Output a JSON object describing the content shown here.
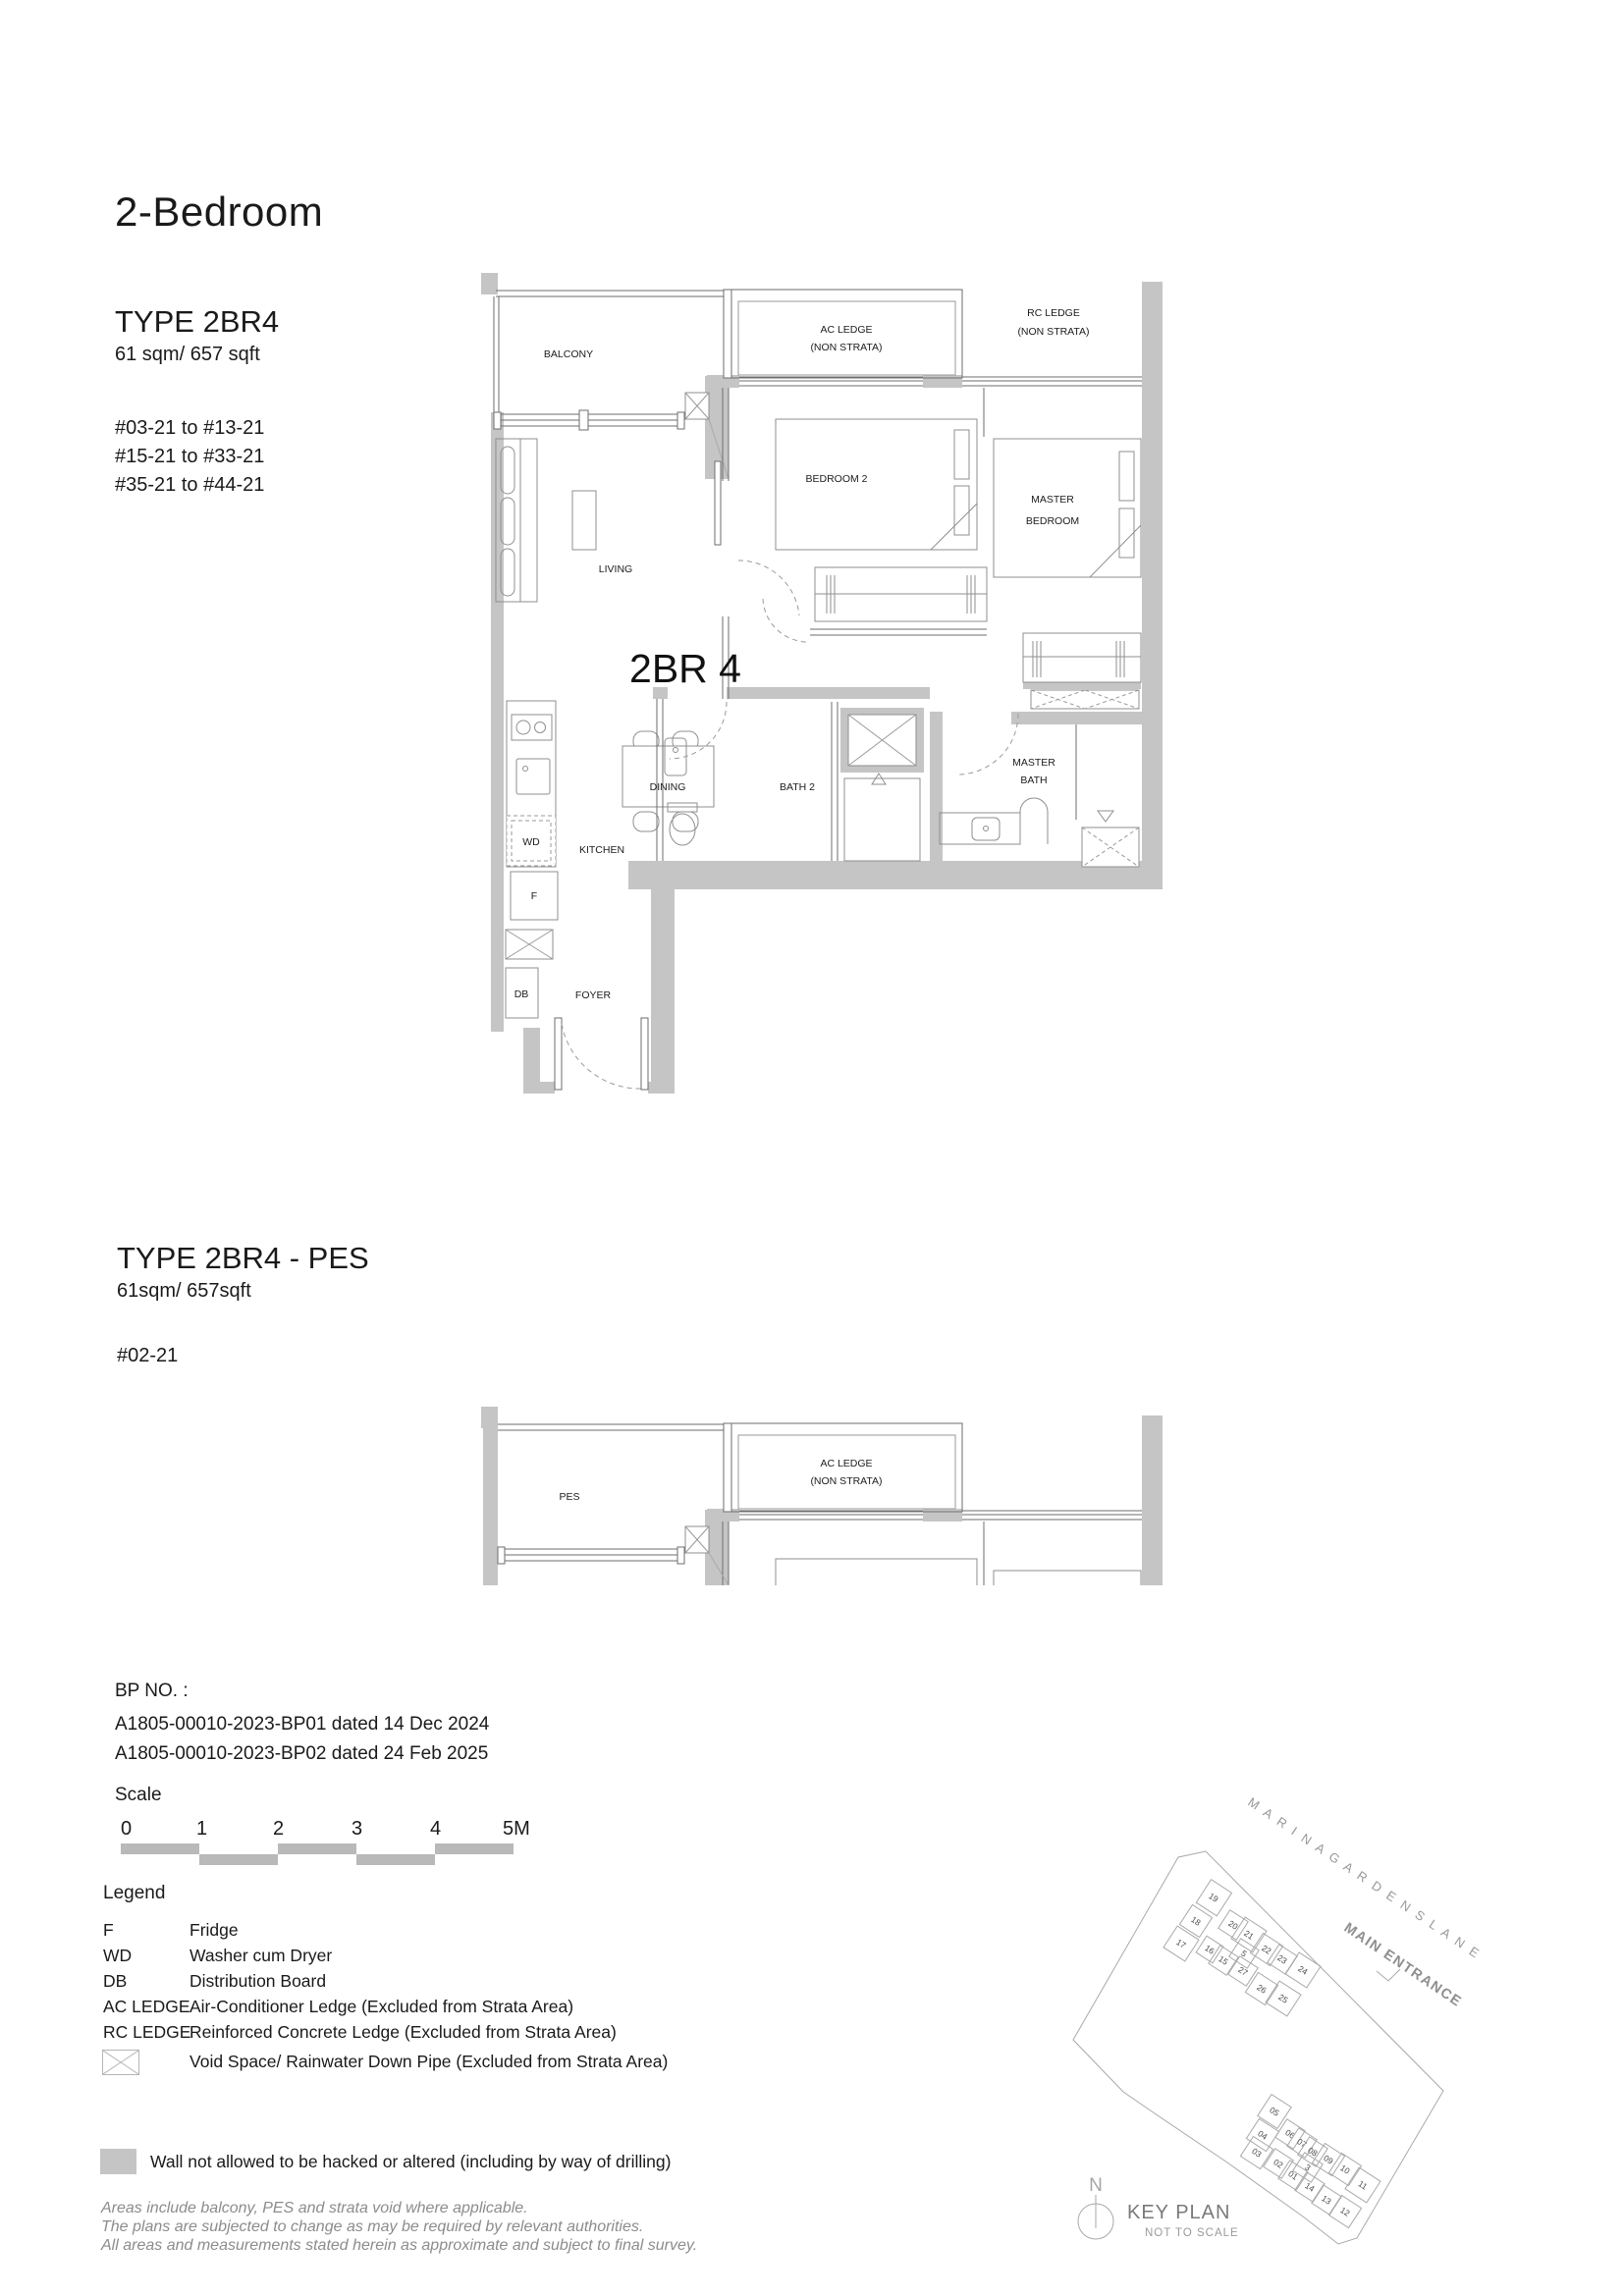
{
  "page": {
    "title": "2-Bedroom"
  },
  "unit_a": {
    "type_title": "TYPE 2BR4",
    "area": "61 sqm/ 657 sqft",
    "levels": [
      "#03-21 to #13-21",
      "#15-21 to #33-21",
      "#35-21 to #44-21"
    ],
    "plan_label": "2BR 4"
  },
  "unit_b": {
    "type_title": "TYPE 2BR4 - PES",
    "area": "61sqm/ 657sqft",
    "levels": [
      "#02-21"
    ]
  },
  "rooms": {
    "balcony": "BALCONY",
    "pes": "PES",
    "ac_ledge": "AC LEDGE",
    "ac_ledge_sub": "(NON STRATA)",
    "rc_ledge": "RC LEDGE",
    "rc_ledge_sub": "(NON STRATA)",
    "living": "LIVING",
    "bedroom2": "BEDROOM 2",
    "master_bedroom_1": "MASTER",
    "master_bedroom_2": "BEDROOM",
    "dining": "DINING",
    "kitchen": "KITCHEN",
    "bath2": "BATH 2",
    "master_bath_1": "MASTER",
    "master_bath_2": "BATH",
    "wd": "WD",
    "f": "F",
    "db": "DB",
    "foyer": "FOYER"
  },
  "bp": {
    "heading": "BP NO. :",
    "line1": "A1805-00010-2023-BP01 dated 14 Dec 2024",
    "line2": "A1805-00010-2023-BP02 dated 24 Feb 2025"
  },
  "scale": {
    "heading": "Scale",
    "ticks": [
      "0",
      "1",
      "2",
      "3",
      "4",
      "5M"
    ]
  },
  "legend": {
    "heading": "Legend",
    "rows": [
      {
        "key": "F",
        "desc": "Fridge"
      },
      {
        "key": "WD",
        "desc": "Washer cum Dryer"
      },
      {
        "key": "DB",
        "desc": "Distribution Board"
      },
      {
        "key": "AC LEDGE",
        "desc": "Air-Conditioner Ledge (Excluded from Strata Area)"
      },
      {
        "key": "RC LEDGE",
        "desc": "Reinforced Concrete Ledge (Excluded from Strata Area)"
      },
      {
        "key": "",
        "desc": "Void Space/ Rainwater Down Pipe (Excluded from Strata Area)"
      }
    ],
    "wall_note": "Wall not allowed to be hacked or altered (including by way of drilling)"
  },
  "disclaimer": [
    "Areas include balcony, PES and strata void where applicable.",
    "The plans are subjected to change as may be required by relevant authorities.",
    "All areas and measurements stated herein as approximate and subject to final survey."
  ],
  "keyplan": {
    "street": "M A R I N A  G A R D E N S  L A N E",
    "entrance": "MAIN ENTRANCE",
    "title": "KEY PLAN",
    "subtitle": "NOT TO SCALE",
    "north": "N",
    "highlighted_unit": "21",
    "units_top": [
      "19",
      "18",
      "17",
      "20",
      "21",
      "16",
      "15",
      "5",
      "22",
      "23",
      "24",
      "27",
      "26",
      "25"
    ],
    "units_bottom": [
      "05",
      "04",
      "03",
      "06",
      "07",
      "08",
      "09",
      "02",
      "01",
      "3",
      "10",
      "11",
      "14",
      "13",
      "12"
    ]
  }
}
